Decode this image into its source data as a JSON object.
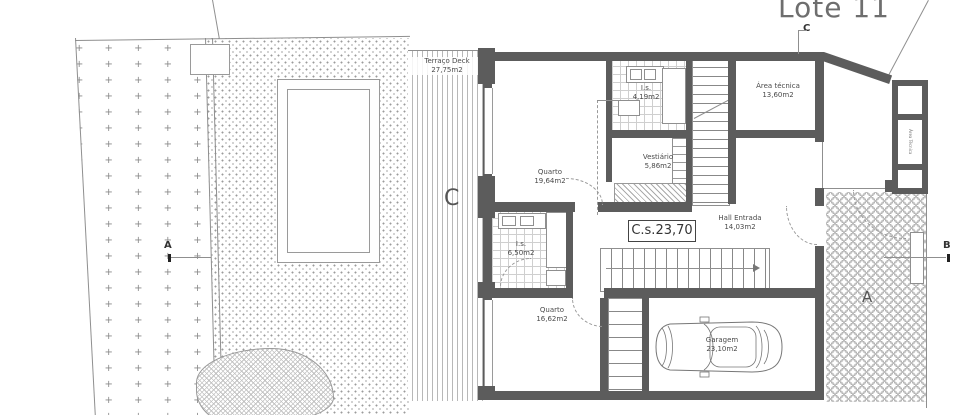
{
  "title": "Lote 11",
  "level_label": "C.s.23,70",
  "markers": {
    "section_a": "A",
    "section_b": "B",
    "section_c": "C",
    "deck_letter": "C",
    "courtyard_letter": "A"
  },
  "rooms": {
    "terraco_deck": {
      "name": "Terraço Deck",
      "area": "27,75m2"
    },
    "quarto_1": {
      "name": "Quarto",
      "area": "19,64m2"
    },
    "is_1": {
      "name": "I.s.",
      "area": "4,19m2"
    },
    "vestiario": {
      "name": "Vestiário",
      "area": "5,86m2"
    },
    "area_tecnica": {
      "name": "Área técnica",
      "area": "13,60m2"
    },
    "hall_entrada": {
      "name": "Hall Entrada",
      "area": "14,03m2"
    },
    "is_2": {
      "name": "I.s.",
      "area": "6,50m2"
    },
    "quarto_2": {
      "name": "Quarto",
      "area": "16,62m2"
    },
    "garagem": {
      "name": "Garagem",
      "area": "23,10m2"
    },
    "area_tecnica_wing": {
      "name": "Área Técnica"
    }
  },
  "patterns": {
    "grass_char": "+"
  },
  "colors": {
    "wall": "#5c5c5c",
    "line": "#8a8a8a",
    "text": "#4a4a4a",
    "title": "#6e6e6e"
  }
}
